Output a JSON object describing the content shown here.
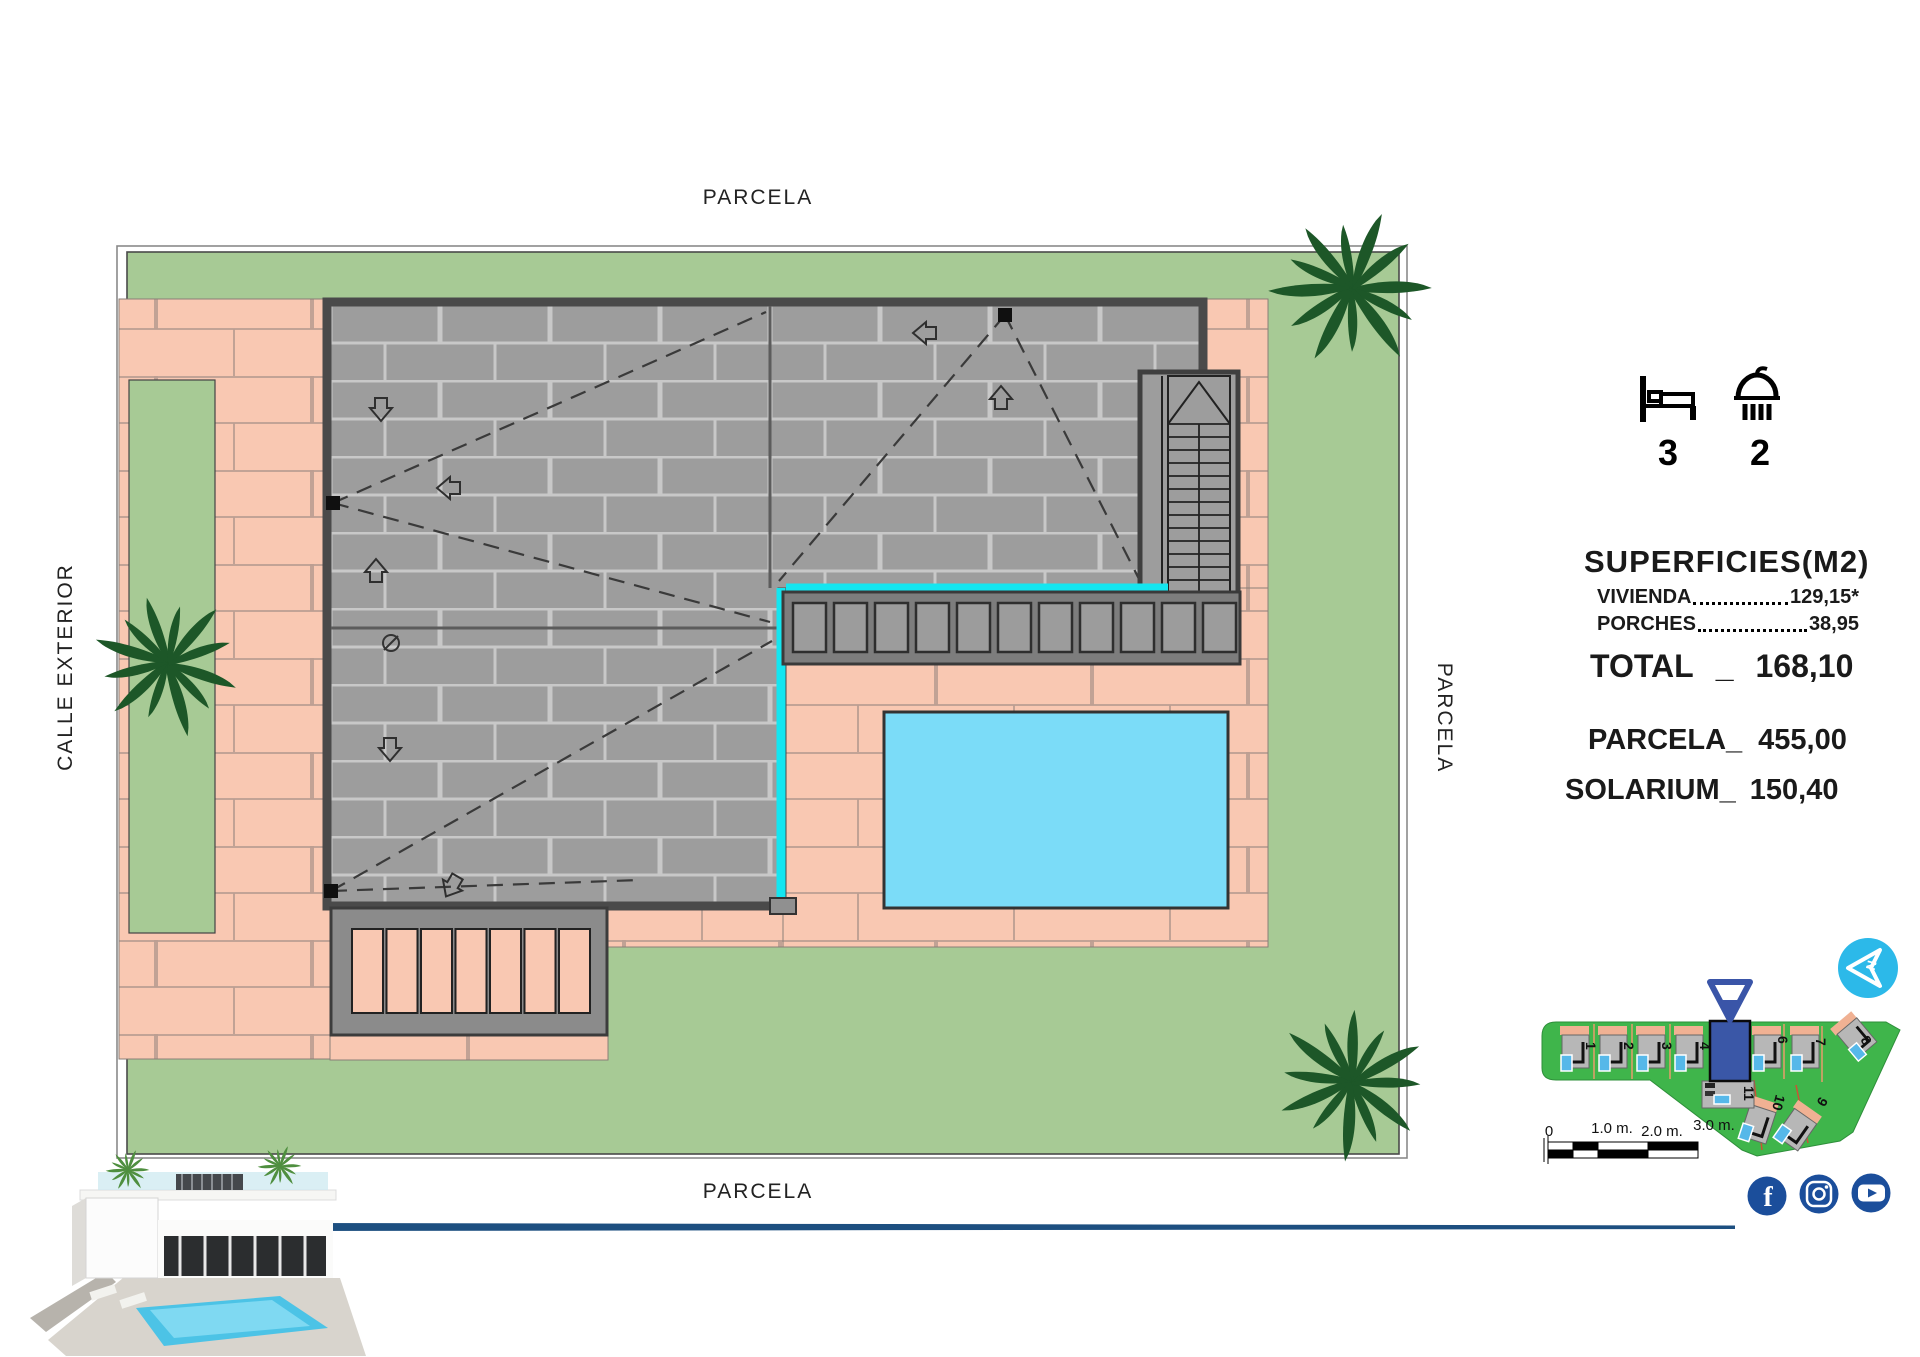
{
  "site_plan": {
    "label_top": "PARCELA",
    "label_bottom": "PARCELA",
    "label_left": "CALLE EXTERIOR",
    "label_right": "PARCELA"
  },
  "features": {
    "bedrooms": "3",
    "bathrooms": "2"
  },
  "areas": {
    "title": "SUPERFICIES(M2)",
    "rows": [
      {
        "label": "VIVIENDA",
        "value": "129,15*"
      },
      {
        "label": "PORCHES",
        "value": "38,95"
      }
    ],
    "total_label": "TOTAL",
    "total_sep": "_",
    "total_value": "168,10",
    "parcela_label": "PARCELA_",
    "parcela_value": "455,00",
    "solarium_label": "SOLARIUM_",
    "solarium_value": "150,40"
  },
  "keymap": {
    "top_plots": [
      "1",
      "2",
      "3",
      "4",
      "6",
      "7",
      "8"
    ],
    "bottom_plots": [
      "11",
      "10",
      "9"
    ]
  },
  "scalebar": {
    "labels": [
      "0",
      "1.0 m.",
      "2.0 m.",
      "3.0 m."
    ]
  },
  "social": {
    "icons": [
      "facebook",
      "instagram",
      "youtube"
    ]
  },
  "compass": {
    "letter": "N"
  },
  "colors": {
    "grass": "#a7ca95",
    "paving_pink": "#f9c8b2",
    "roof_gray": "#9d9d9d",
    "pool_cyan": "#7bdcf8",
    "edge_cyan": "#14e6f0",
    "palm_green": "#1d5728",
    "keymap_green": "#3fb54b",
    "highlight_blue": "#3a57a7",
    "social_blue": "#1b4e9b",
    "compass_cyan": "#2cb9e9"
  }
}
